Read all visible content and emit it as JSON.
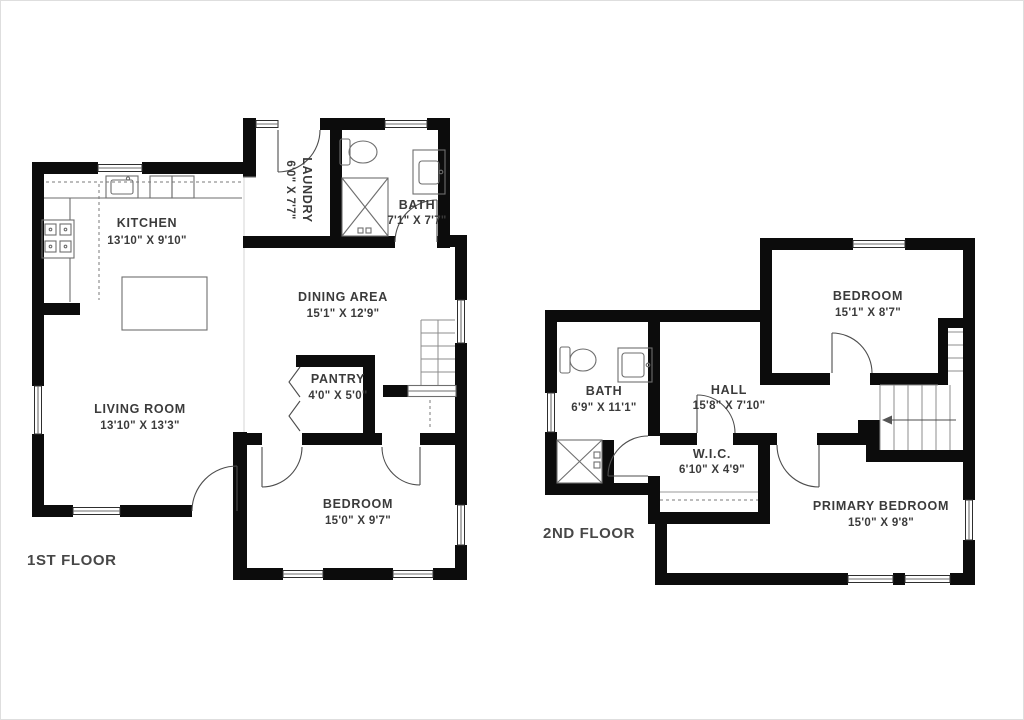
{
  "page": {
    "background": "#ffffff",
    "wall_color": "#0c0c0c",
    "text_color": "#3b3b3b"
  },
  "floors": [
    {
      "label": "1ST FLOOR",
      "rooms": [
        {
          "name": "KITCHEN",
          "dims": "13'10\" X 9'10\""
        },
        {
          "name": "LAUNDRY",
          "dims": "6'0\" X 7'7\""
        },
        {
          "name": "BATH",
          "dims": "7'1\" X 7'7\""
        },
        {
          "name": "DINING AREA",
          "dims": "15'1\" X 12'9\""
        },
        {
          "name": "PANTRY",
          "dims": "4'0\" X 5'0\""
        },
        {
          "name": "LIVING ROOM",
          "dims": "13'10\" X 13'3\""
        },
        {
          "name": "BEDROOM",
          "dims": "15'0\" X 9'7\""
        }
      ]
    },
    {
      "label": "2ND FLOOR",
      "rooms": [
        {
          "name": "BEDROOM",
          "dims": "15'1\" X 8'7\""
        },
        {
          "name": "BATH",
          "dims": "6'9\" X 11'1\""
        },
        {
          "name": "HALL",
          "dims": "15'8\" X 7'10\""
        },
        {
          "name": "W.I.C.",
          "dims": "6'10\" X 4'9\""
        },
        {
          "name": "PRIMARY BEDROOM",
          "dims": "15'0\" X 9'8\""
        }
      ]
    }
  ]
}
